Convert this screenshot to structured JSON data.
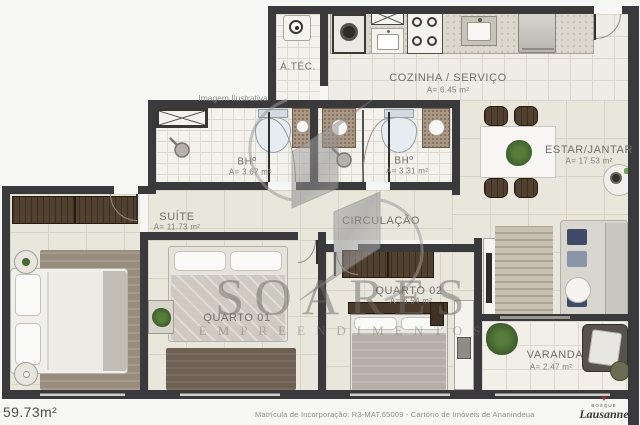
{
  "notes": {
    "illustrative": "Imagem Ilustrativa"
  },
  "rooms": {
    "atec": {
      "label": "Á.TÉC."
    },
    "cozinha": {
      "label": "COZINHA / SERVIÇO",
      "area": "A= 6.45 m²"
    },
    "bh1": {
      "label": "BHº",
      "area": "A= 3.67 m²"
    },
    "bh2": {
      "label": "BHº",
      "area": "A= 3.31 m²"
    },
    "estar": {
      "label": "ESTAR/JANTAR",
      "area": "A= 17.53 m²"
    },
    "suite": {
      "label": "SUÍTE",
      "area": "A= 11.73 m²"
    },
    "circulacao": {
      "label": "CIRCULAÇÃO"
    },
    "quarto01": {
      "label": "QUARTO 01"
    },
    "quarto02": {
      "label": "QUARTO 02",
      "area": "A= 6.54 m²"
    },
    "varanda": {
      "label": "VARANDA",
      "area": "A= 2.47 m²"
    }
  },
  "watermark": {
    "name": "SOARES",
    "subtitle": "EMPREENDIMENTOS"
  },
  "footer": {
    "total_area": "59.73m²",
    "registry": "Matrícula de Incorporação: R3-MAT.65009 - Cartório de Imóveis de Ananindeua",
    "brand_heart": "♥",
    "brand_top": "BOSQUE",
    "brand_name": "Lausanne"
  },
  "colors": {
    "wall": "#3a3a3c",
    "floor_beige": "#e9e6dc",
    "tile_light": "#f2f1eb",
    "wood_dark": "#53412f",
    "plant_green": "#49682f",
    "brand_red": "#c0272d",
    "watermark_gray": "#6c6a64"
  }
}
